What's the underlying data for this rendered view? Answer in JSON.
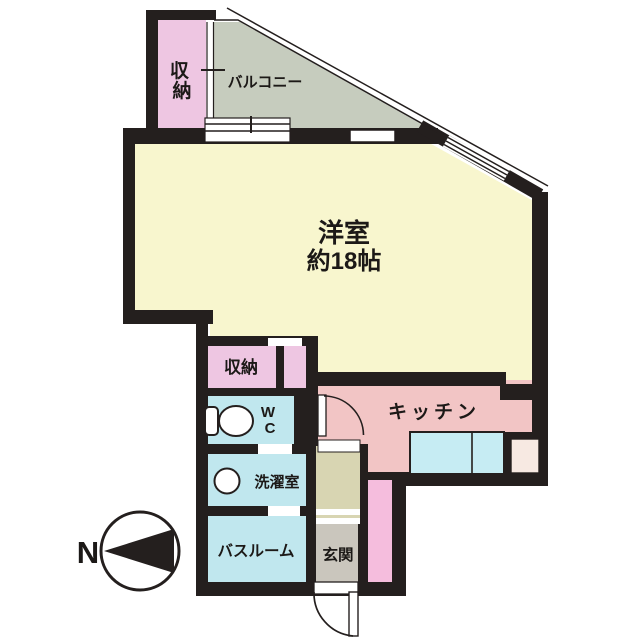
{
  "plan": {
    "rooms": {
      "closet_top": {
        "label": "収納",
        "char1": "収",
        "char2": "納"
      },
      "balcony": {
        "label": "バルコニー"
      },
      "living": {
        "name": "洋室",
        "size": "約18帖"
      },
      "closet_mid": {
        "label": "収納"
      },
      "wc": {
        "line1": "W",
        "line2": "C"
      },
      "kitchen": {
        "label": "キッチン"
      },
      "laundry": {
        "label": "洗濯室"
      },
      "bathroom": {
        "label": "バスルーム"
      },
      "entrance": {
        "label": "玄関"
      }
    },
    "compass": {
      "north_label": "N"
    }
  },
  "colors": {
    "wall": "#241f1e",
    "living": "#f8f6ce",
    "balcony": "#c6ccbe",
    "closet": "#eec6e2",
    "kitchen": "#f2c5c5",
    "wet_room": "#c0e7ee",
    "counter": "#c6ecf3",
    "hall": "#d8d5b2",
    "entrance_floor": "#cac6bd",
    "accent_pink": "#f5bddd",
    "service_door": "#f7e9e2",
    "paper": "#ffffff"
  }
}
